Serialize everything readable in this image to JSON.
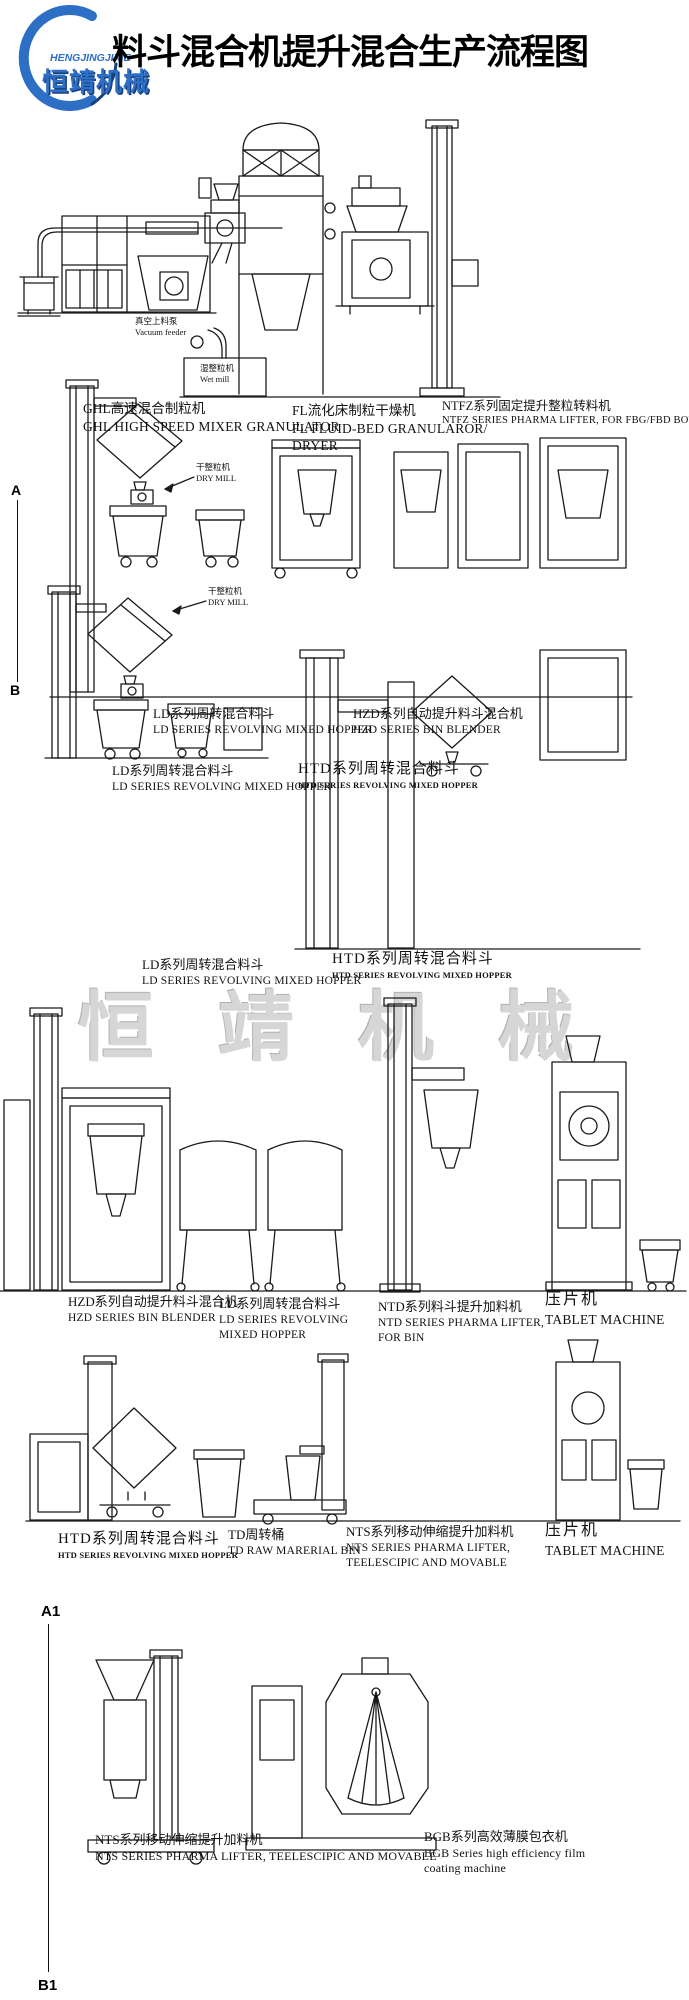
{
  "header": {
    "title": "料斗混合机提升混合生产流程图",
    "logo": {
      "en": "HENGJINGJIXIE",
      "zh": "恒靖机械",
      "color": "#2e6fc6"
    }
  },
  "watermark": "恒靖机械",
  "markers": {
    "a": "A",
    "b": "B",
    "a1": "A1",
    "b1": "B1"
  },
  "component_labels": {
    "vacuum_feeder": {
      "zh": "真空上料泵",
      "en": "Vacuum feeder"
    },
    "wet_mill": {
      "zh": "湿整粒机",
      "en": "Wet mill"
    },
    "dry_mill": {
      "zh": "干整粒机",
      "en": "DRY MILL"
    }
  },
  "captions": {
    "ghl": {
      "zh": "GHL高速混合制粒机",
      "en1": "GHL HIGH SPEED MIXER GRANULATOR"
    },
    "fl": {
      "zh": "FL流化床制粒干燥机",
      "en1": "FL FLUID-BED GRANULAROR/",
      "en2": "DRYER"
    },
    "ntfz": {
      "zh": "NTFZ系列固定提升整粒转料机",
      "en1": "NTFZ SERIES PHARMA LIFTER, FOR  FBG/FBD BOWL."
    },
    "ld_row2": {
      "zh": "LD系列周转混合料斗",
      "en1": "LD SERIES REVOLVING MIXED HOPPER"
    },
    "hzd_row2": {
      "zh": "HZD系列自动提升料斗混合机",
      "en1": "HZD SERIES BIN BLENDER"
    },
    "ld_row3": {
      "zh": "LD系列周转混合料斗",
      "en1": "LD SERIES REVOLVING MIXED HOPPER"
    },
    "htd_row3": {
      "zh": "HTD系列周转混合料斗",
      "en1": "HTD SERIES REVOLVING MIXED HOPPER"
    },
    "ld_row4": {
      "zh": "LD系列周转混合料斗",
      "en1": "LD SERIES REVOLVING MIXED HOPPER"
    },
    "htd_row4": {
      "zh": "HTD系列周转混合料斗",
      "en1": "HTD SERIES REVOLVING MIXED HOPPER"
    },
    "hzd_row5": {
      "zh": "HZD系列自动提升料斗混合机",
      "en1": "HZD SERIES BIN BLENDER"
    },
    "ld_row5": {
      "zh": "LD系列周转混合料斗",
      "en1": "LD SERIES REVOLVING",
      "en2": "MIXED HOPPER"
    },
    "ntd_row5": {
      "zh": "NTD系列料斗提升加料机",
      "en1": "NTD SERIES PHARMA LIFTER,",
      "en2": "FOR BIN"
    },
    "tablet_row5": {
      "zh": "压片机",
      "en1": "TABLET MACHINE"
    },
    "htd_row6": {
      "zh": "HTD系列周转混合料斗",
      "en1": "HTD SERIES REVOLVING MIXED HOPPER"
    },
    "td_row6": {
      "zh": "TD周转桶",
      "en1": "TD RAW MARERIAL BIN"
    },
    "nts_row6": {
      "zh": "NTS系列移动伸缩提升加料机",
      "en1": "NTS SERIES PHARMA LIFTER,",
      "en2": "TEELESCIPIC AND MOVABLE"
    },
    "tablet_row6": {
      "zh": "压片机",
      "en1": "TABLET MACHINE"
    },
    "nts_row7": {
      "zh": "NTS系列移动伸缩提升加料机",
      "en1": "NTS SERIES PHARMA LIFTER, TEELESCIPIC AND MOVABLE"
    },
    "bgb_row7": {
      "zh": "BGB系列高效薄膜包衣机",
      "en1": "BGB Series high efficiency film",
      "en2": "coating machine"
    }
  }
}
